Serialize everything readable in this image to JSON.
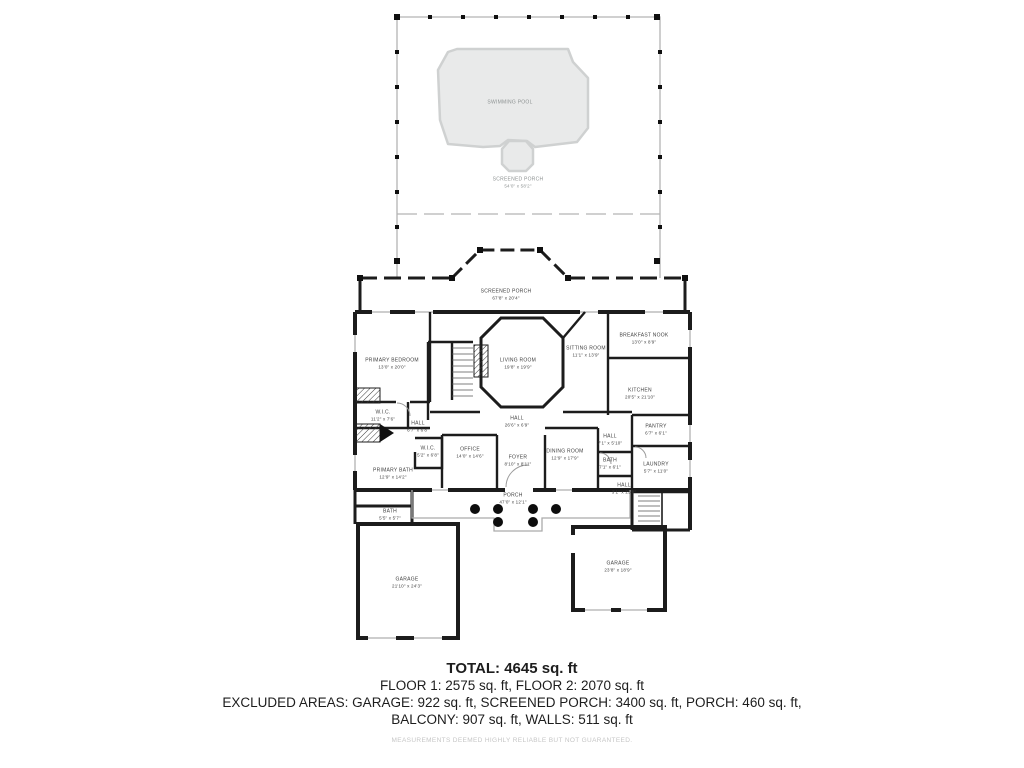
{
  "colors": {
    "wall": "#1c1c1c",
    "screen_line": "#b3b3b3",
    "pool_fill": "#e9eaea",
    "pool_stroke": "#cfd1d1",
    "label_text": "#3f3f3f",
    "disclaimer_text": "#c6c6c6"
  },
  "rooms": [
    {
      "name": "SWIMMING POOL",
      "dims": ""
    },
    {
      "name": "SCREENED PORCH",
      "dims": "54'0\" x 58'2\""
    },
    {
      "name": "SCREENED PORCH",
      "dims": "67'8\" x 20'4\""
    },
    {
      "name": "PRIMARY BEDROOM",
      "dims": "13'0\" x 20'0\""
    },
    {
      "name": "LIVING ROOM",
      "dims": "19'8\" x 19'9\""
    },
    {
      "name": "SITTING ROOM",
      "dims": "11'1\" x 13'9\""
    },
    {
      "name": "BREAKFAST NOOK",
      "dims": "13'0\" x 8'9\""
    },
    {
      "name": "KITCHEN",
      "dims": "20'5\" x 21'10\""
    },
    {
      "name": "W.I.C.",
      "dims": "11'2\" x 7'6\""
    },
    {
      "name": "HALL",
      "dims": "6'7\" x 6'8\""
    },
    {
      "name": "W.I.C.",
      "dims": "5'2\" x 6'8\""
    },
    {
      "name": "OFFICE",
      "dims": "14'0\" x 14'6\""
    },
    {
      "name": "HALL",
      "dims": "26'6\" x 6'9\""
    },
    {
      "name": "FOYER",
      "dims": "8'10\" x 8'11\""
    },
    {
      "name": "DINING ROOM",
      "dims": "12'9\" x 17'9\""
    },
    {
      "name": "HALL",
      "dims": "7'1\" x 5'10\""
    },
    {
      "name": "BATH",
      "dims": "7'1\" x 6'1\""
    },
    {
      "name": "PANTRY",
      "dims": "6'7\" x 6'1\""
    },
    {
      "name": "LAUNDRY",
      "dims": "5'7\" x 11'0\""
    },
    {
      "name": "HALL",
      "dims": "3'1\" x 23'0\""
    },
    {
      "name": "PRIMARY BATH",
      "dims": "12'9\" x 14'2\""
    },
    {
      "name": "BATH",
      "dims": "5'5\" x 5'7\""
    },
    {
      "name": "PORCH",
      "dims": "47'0\" x 12'1\""
    },
    {
      "name": "GARAGE",
      "dims": "21'10\" x 24'3\""
    },
    {
      "name": "GARAGE",
      "dims": "23'8\" x 18'9\""
    }
  ],
  "summary": {
    "total": "TOTAL: 4645 sq. ft",
    "floors": "FLOOR 1: 2575 sq. ft, FLOOR 2: 2070 sq. ft",
    "excluded_1": "EXCLUDED AREAS: GARAGE: 922 sq. ft, SCREENED PORCH: 3400 sq. ft, PORCH: 460 sq. ft,",
    "excluded_2": "BALCONY: 907 sq. ft, WALLS: 511 sq. ft",
    "disclaimer": "MEASUREMENTS DEEMED HIGHLY RELIABLE BUT NOT GUARANTEED."
  }
}
